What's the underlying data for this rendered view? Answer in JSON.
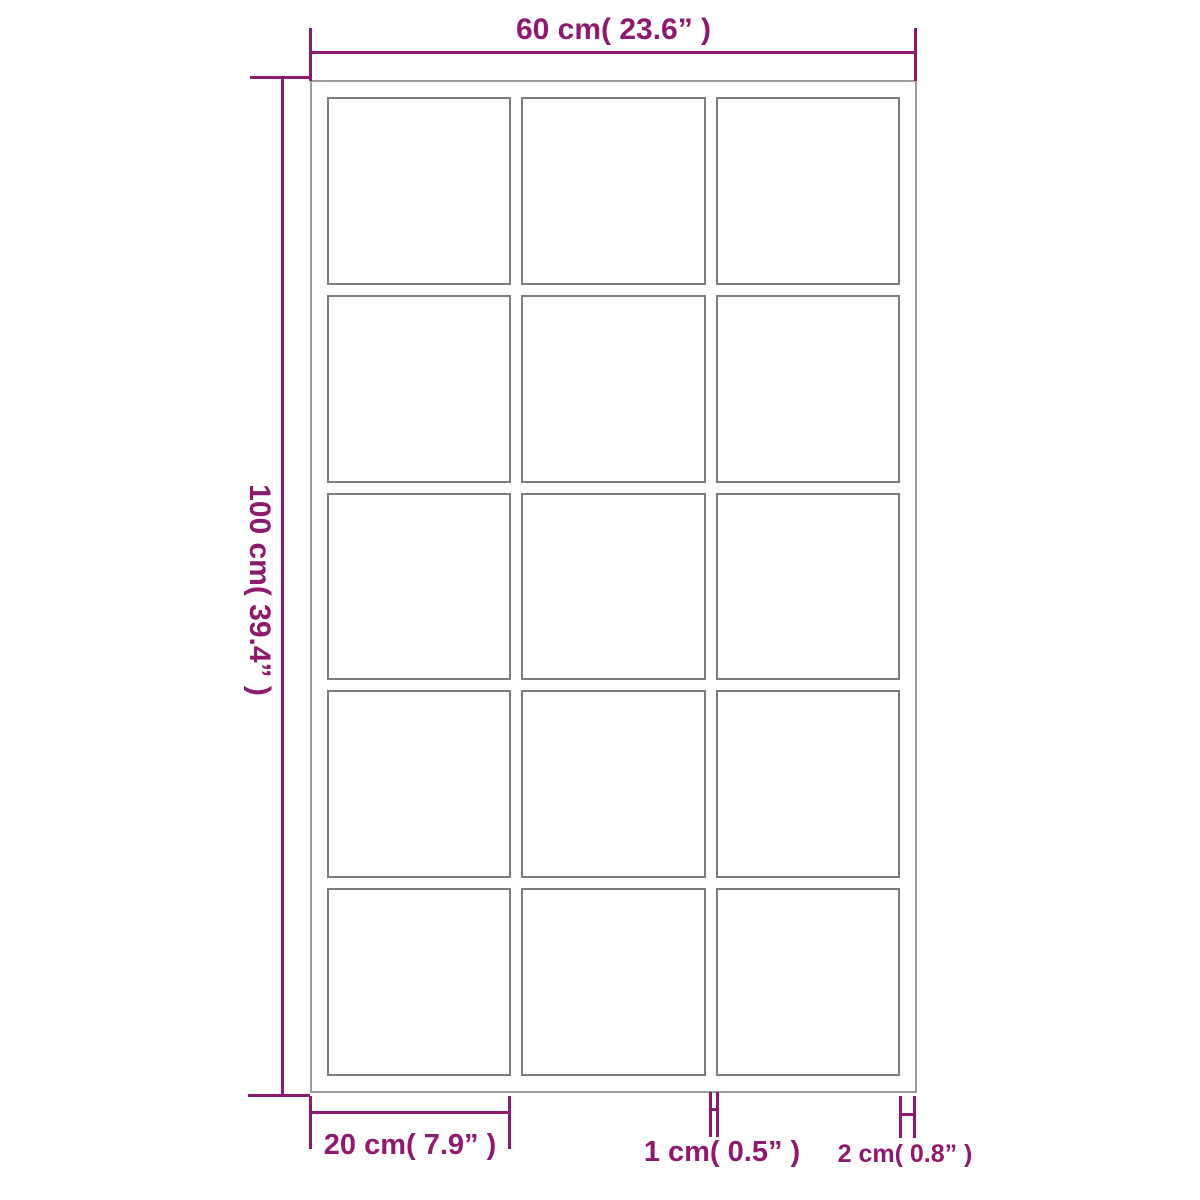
{
  "diagram": {
    "type": "product-dimension-diagram",
    "subject": "grid frame with 15 panes",
    "colors": {
      "accent": "#8d1a6e",
      "frame_outline": "#9c9c9c",
      "pane_outline": "#7d7d7d",
      "background": "#ffffff"
    },
    "grid": {
      "columns": 3,
      "rows": 5,
      "pane_count": 15
    },
    "dimensions": {
      "width": {
        "label": "60 cm( 23.6”  )",
        "cm": 60,
        "inches": 23.6
      },
      "height": {
        "label": "100 cm( 39.4”  )",
        "cm": 100,
        "inches": 39.4
      },
      "pane_width": {
        "label": "20 cm( 7.9”  )",
        "cm": 20,
        "inches": 7.9
      },
      "bar_width": {
        "label": "1 cm( 0.5”  )",
        "cm": 1,
        "inches": 0.5
      },
      "frame_depth": {
        "label": "2 cm( 0.8”  )",
        "cm": 2,
        "inches": 0.8
      }
    }
  }
}
